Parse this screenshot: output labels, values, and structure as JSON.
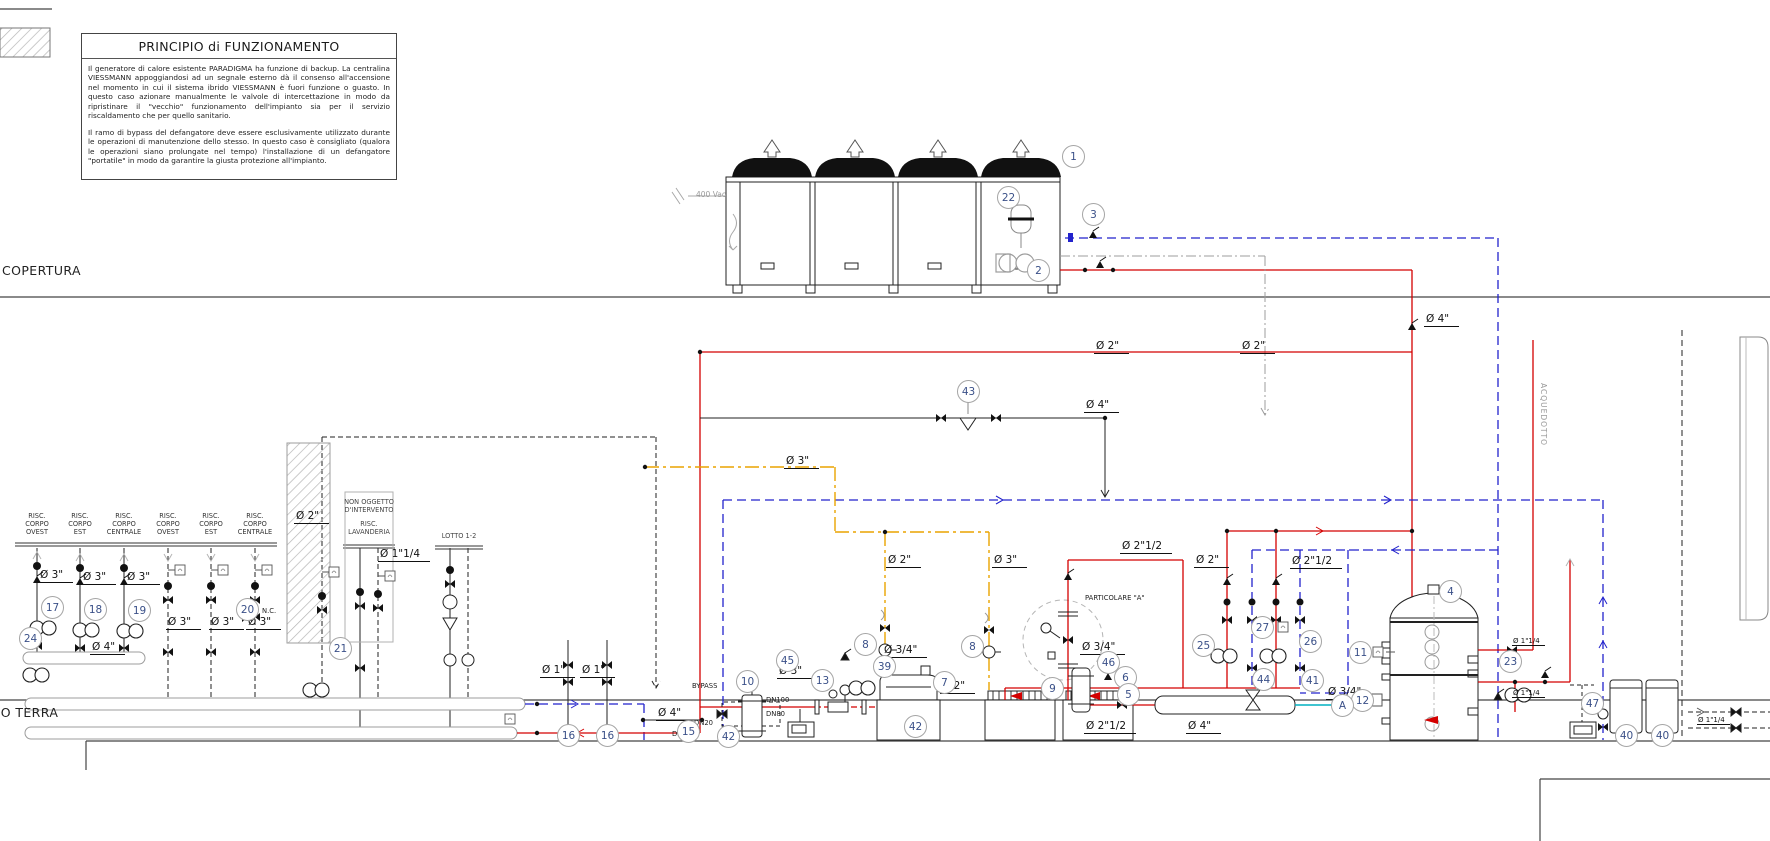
{
  "title_box": {
    "title": "PRINCIPIO di FUNZIONAMENTO",
    "p1": "Il generatore di calore esistente PARADIGMA ha funzione di backup. La centralina VIESSMANN appoggiandosi ad un segnale esterno dà il consenso all'accensione nel momento in cui il sistema ibrido VIESSMANN è fuori funzione o guasto. In questo caso azionare manualmente le valvole di intercettazione in modo da ripristinare il \"vecchio\" funzionamento dell'impianto sia per il servizio riscaldamento che per quello sanitario.",
    "p2": "Il ramo di bypass del defangatore deve essere esclusivamente utilizzato durante le operazioni di manutenzione dello stesso. In questo caso è consigliato (qualora le operazioni siano prolungate nel tempo) l'installazione di un defangatore \"portatile\" in modo da garantire la giusta protezione all'impianto."
  },
  "levels": {
    "roof": "COPERTURA",
    "ground": "PIANO TERRA"
  },
  "colors": {
    "supply_hot": "#d40000",
    "return_line": "#2222cc",
    "gas_line": "#eaa400",
    "neutral_gray": "#9c9c9c",
    "callout_number": "#3a5088",
    "teal_stub": "#00b0c0",
    "line_black": "#1a1a1a"
  },
  "icons": {
    "shutoff-valve-icon": "black bowtie triangles",
    "pump-icon": "twin overlapping circles",
    "sensor-well-icon": "small square with tick",
    "fan-icon": "black dome with hollow up arrow",
    "expansion-vessel-icon": "rounded vessel with band",
    "strainer-icon": "downward triangle"
  },
  "circuit_headers": [
    {
      "x": 37,
      "lines": "RISC.\nCORPO\nOVEST"
    },
    {
      "x": 80,
      "lines": "RISC.\nCORPO\nEST"
    },
    {
      "x": 124,
      "lines": "RISC.\nCORPO\nCENTRALE"
    },
    {
      "x": 168,
      "lines": "RISC.\nCORPO\nOVEST"
    },
    {
      "x": 211,
      "lines": "RISC.\nCORPO\nEST"
    },
    {
      "x": 255,
      "lines": "RISC.\nCORPO\nCENTRALE"
    }
  ],
  "box_labels": [
    {
      "x": 369,
      "y": 499,
      "lines": "NON OGGETTO\nD'INTERVENTO"
    },
    {
      "x": 369,
      "y": 521,
      "lines": "RISC.\nLAVANDERIA"
    },
    {
      "x": 459,
      "y": 533,
      "lines": "LOTTO 1-2"
    }
  ],
  "labels": [
    {
      "t": "Ø 3\"",
      "x": 38,
      "y": 569,
      "c": "dia"
    },
    {
      "t": "Ø 3\"",
      "x": 81,
      "y": 571,
      "c": "dia"
    },
    {
      "t": "Ø 3\"",
      "x": 125,
      "y": 571,
      "c": "dia"
    },
    {
      "t": "Ø 3\"",
      "x": 166,
      "y": 616,
      "c": "dia"
    },
    {
      "t": "Ø 3\"",
      "x": 209,
      "y": 616,
      "c": "dia"
    },
    {
      "t": "Ø 3\"",
      "x": 246,
      "y": 616,
      "c": "dia"
    },
    {
      "t": "Ø 2\"",
      "x": 294,
      "y": 510,
      "c": "dia"
    },
    {
      "t": "Ø 1\"1/4",
      "x": 378,
      "y": 548,
      "c": "dia"
    },
    {
      "t": "Ø 4\"",
      "x": 90,
      "y": 641,
      "c": "dia"
    },
    {
      "t": "Ø 1\"",
      "x": 540,
      "y": 664,
      "c": "dia"
    },
    {
      "t": "Ø 1\"",
      "x": 580,
      "y": 664,
      "c": "dia"
    },
    {
      "t": "Ø 4\"",
      "x": 656,
      "y": 707,
      "c": "dia"
    },
    {
      "t": "Ø 3\"",
      "x": 777,
      "y": 665,
      "c": "dia"
    },
    {
      "t": "Ø 3\"",
      "x": 784,
      "y": 455,
      "c": "dia"
    },
    {
      "t": "Ø 2\"",
      "x": 886,
      "y": 554,
      "c": "dia"
    },
    {
      "t": "Ø 3\"",
      "x": 992,
      "y": 554,
      "c": "dia"
    },
    {
      "t": "Ø 2\"",
      "x": 1094,
      "y": 340,
      "c": "dia"
    },
    {
      "t": "Ø 2\"",
      "x": 1240,
      "y": 340,
      "c": "dia"
    },
    {
      "t": "Ø 4\"",
      "x": 1084,
      "y": 399,
      "c": "dia"
    },
    {
      "t": "Ø 4\"",
      "x": 1424,
      "y": 313,
      "c": "dia"
    },
    {
      "t": "Ø 2\"1/2",
      "x": 1120,
      "y": 540,
      "c": "dia"
    },
    {
      "t": "Ø 2\"",
      "x": 1194,
      "y": 554,
      "c": "dia"
    },
    {
      "t": "Ø 2\"1/2",
      "x": 1290,
      "y": 555,
      "c": "dia"
    },
    {
      "t": "Ø 2\"",
      "x": 940,
      "y": 680,
      "c": "dia"
    },
    {
      "t": "Ø 2\"1/2",
      "x": 1084,
      "y": 720,
      "c": "dia"
    },
    {
      "t": "Ø 4\"",
      "x": 1186,
      "y": 720,
      "c": "dia"
    },
    {
      "t": "Ø 3/4\"",
      "x": 882,
      "y": 644,
      "c": "dia"
    },
    {
      "t": "Ø 3/4\"",
      "x": 1080,
      "y": 641,
      "c": "dia"
    },
    {
      "t": "Ø 3/4\"",
      "x": 1326,
      "y": 686,
      "c": "dia"
    },
    {
      "t": "Ø 1\"1/4",
      "x": 1512,
      "y": 637,
      "c": "dias"
    },
    {
      "t": "Ø 1\"1/4",
      "x": 1512,
      "y": 689,
      "c": "dias"
    },
    {
      "t": "Ø 1\"1/4",
      "x": 1697,
      "y": 716,
      "c": "dias"
    },
    {
      "t": "400 Vac",
      "x": 696,
      "y": 190,
      "c": "smg"
    },
    {
      "t": "BYPASS",
      "x": 692,
      "y": 682,
      "c": "sm"
    },
    {
      "t": "DN100",
      "x": 766,
      "y": 696,
      "c": "sm"
    },
    {
      "t": "DN80",
      "x": 766,
      "y": 710,
      "c": "sm"
    },
    {
      "t": "DN20",
      "x": 694,
      "y": 719,
      "c": "sm"
    },
    {
      "t": "DN20",
      "x": 672,
      "y": 730,
      "c": "sm"
    },
    {
      "t": "N.C.",
      "x": 262,
      "y": 607,
      "c": "sm"
    },
    {
      "t": "PARTICOLARE \"A\"",
      "x": 1085,
      "y": 594,
      "c": "sm"
    },
    {
      "t": "ACQUEDOTTO",
      "x": 1548,
      "y": 383,
      "c": "vert"
    }
  ],
  "callouts": [
    {
      "n": "1",
      "x": 1073,
      "y": 156
    },
    {
      "n": "22",
      "x": 1008,
      "y": 197
    },
    {
      "n": "2",
      "x": 1038,
      "y": 270
    },
    {
      "n": "3",
      "x": 1093,
      "y": 214
    },
    {
      "n": "43",
      "x": 968,
      "y": 391
    },
    {
      "n": "17",
      "x": 52,
      "y": 607
    },
    {
      "n": "18",
      "x": 95,
      "y": 609
    },
    {
      "n": "19",
      "x": 139,
      "y": 610
    },
    {
      "n": "20",
      "x": 247,
      "y": 609
    },
    {
      "n": "21",
      "x": 340,
      "y": 648
    },
    {
      "n": "24",
      "x": 30,
      "y": 638
    },
    {
      "n": "16",
      "x": 568,
      "y": 735
    },
    {
      "n": "16",
      "x": 607,
      "y": 735
    },
    {
      "n": "15",
      "x": 688,
      "y": 731
    },
    {
      "n": "13",
      "x": 822,
      "y": 680
    },
    {
      "n": "45",
      "x": 787,
      "y": 660
    },
    {
      "n": "42",
      "x": 728,
      "y": 736
    },
    {
      "n": "42",
      "x": 915,
      "y": 726
    },
    {
      "n": "10",
      "x": 747,
      "y": 681
    },
    {
      "n": "39",
      "x": 884,
      "y": 666
    },
    {
      "n": "7",
      "x": 944,
      "y": 682
    },
    {
      "n": "8",
      "x": 865,
      "y": 644
    },
    {
      "n": "8",
      "x": 972,
      "y": 646
    },
    {
      "n": "6",
      "x": 1125,
      "y": 677
    },
    {
      "n": "9",
      "x": 1052,
      "y": 688
    },
    {
      "n": "46",
      "x": 1108,
      "y": 662
    },
    {
      "n": "5",
      "x": 1128,
      "y": 694
    },
    {
      "n": "41",
      "x": 1312,
      "y": 680
    },
    {
      "n": "25",
      "x": 1203,
      "y": 645
    },
    {
      "n": "27",
      "x": 1262,
      "y": 627
    },
    {
      "n": "26",
      "x": 1310,
      "y": 641
    },
    {
      "n": "44",
      "x": 1263,
      "y": 679
    },
    {
      "n": "11",
      "x": 1360,
      "y": 652
    },
    {
      "n": "4",
      "x": 1450,
      "y": 591
    },
    {
      "n": "12",
      "x": 1362,
      "y": 700
    },
    {
      "n": "23",
      "x": 1510,
      "y": 661
    },
    {
      "n": "47",
      "x": 1592,
      "y": 703
    },
    {
      "n": "40",
      "x": 1626,
      "y": 735
    },
    {
      "n": "40",
      "x": 1662,
      "y": 735
    },
    {
      "n": "A",
      "x": 1342,
      "y": 705
    }
  ]
}
